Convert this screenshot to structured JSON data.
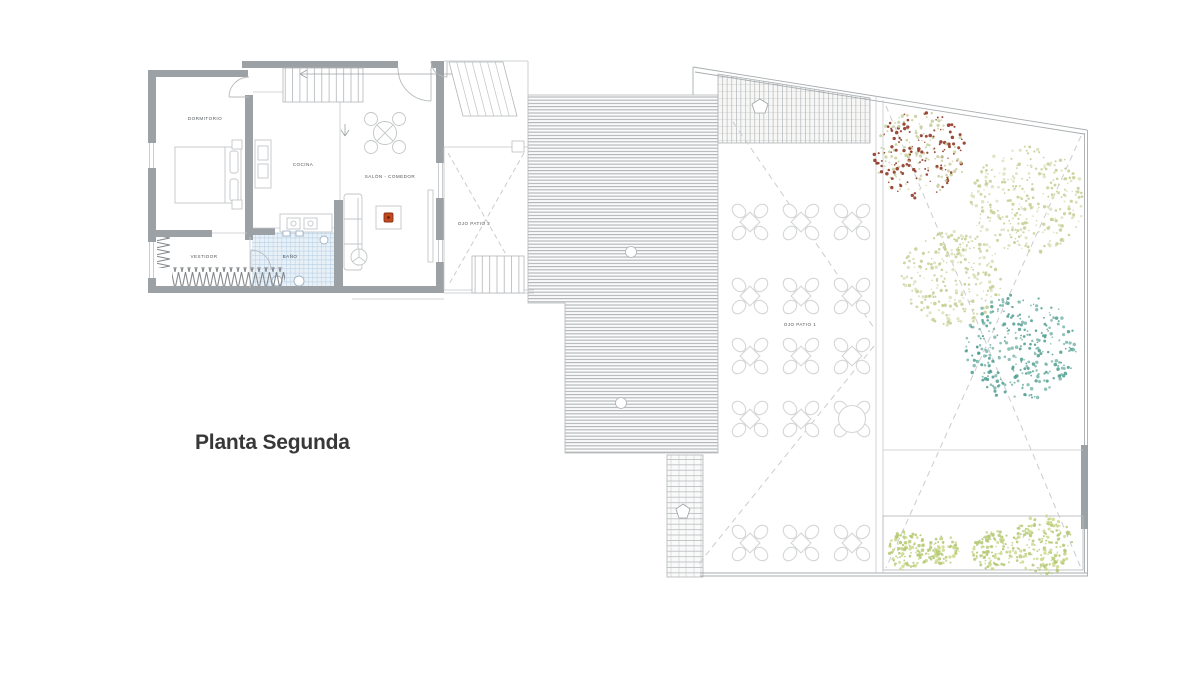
{
  "title": "Planta Segunda",
  "plan": {
    "rooms": {
      "dormitorio": "DORMITORIO",
      "cocina": "COCINA",
      "salon_comedor": "SALÓN - COMEDOR",
      "vestidor": "VESTIDOR",
      "bano": "BAÑO"
    },
    "patios": {
      "ojo_patio_2": "OJO PATIO 2",
      "ojo_patio_1": "OJO PATIO 1"
    }
  },
  "colors": {
    "wall_gray": "#9ba1a4",
    "line_gray": "#b2b6b9",
    "light_line": "#c6c9cb",
    "tile_blue": "#b7cfe3",
    "accent_red": "#bf4a21",
    "tree_red": "#8a2b16",
    "tree_olive": "#c6cd92",
    "tree_olive_light": "#dce1bb",
    "tree_teal": "#4e9c8e",
    "tree_teal_light": "#7db7ab",
    "shrub_green": "#b4c873",
    "shrub_green_light": "#cdd98f",
    "title_text": "#383838",
    "label_text": "#54585b"
  },
  "terrace": {
    "tables": {
      "cols_x": [
        750,
        801,
        852
      ],
      "rows_y": [
        222,
        296,
        356,
        419,
        543
      ],
      "large": {
        "row": 3,
        "col": 2
      }
    }
  },
  "trees": [
    {
      "name": "tree-red",
      "x": 920,
      "y": 155,
      "r": 46,
      "dots": 250,
      "mix": 0.5,
      "color": "#8a2b16",
      "color2": "#c8cf9d"
    },
    {
      "name": "tree-olive-top",
      "x": 1027,
      "y": 200,
      "r": 57,
      "dots": 300,
      "mix": 0.6,
      "color": "#c6cd92",
      "color2": "#dce1bb"
    },
    {
      "name": "tree-olive-mid",
      "x": 952,
      "y": 278,
      "r": 51,
      "dots": 260,
      "mix": 0.6,
      "color": "#c6cd92",
      "color2": "#dce1bb"
    },
    {
      "name": "tree-teal",
      "x": 1020,
      "y": 347,
      "r": 56,
      "dots": 300,
      "mix": 0.55,
      "color": "#4e9c8e",
      "color2": "#7db7ab"
    },
    {
      "name": "planter-shrub-1",
      "x": 908,
      "y": 551,
      "r": 21,
      "dots": 110,
      "mix": 0.6,
      "color": "#b4c873",
      "color2": "#cdd98f"
    },
    {
      "name": "planter-shrub-2",
      "x": 944,
      "y": 551,
      "r": 16,
      "dots": 80,
      "mix": 0.6,
      "color": "#b4c873",
      "color2": "#cdd98f"
    },
    {
      "name": "planter-shrub-3",
      "x": 993,
      "y": 550,
      "r": 21,
      "dots": 110,
      "mix": 0.6,
      "color": "#b4c873",
      "color2": "#cdd98f"
    },
    {
      "name": "planter-shrub-4",
      "x": 1043,
      "y": 545,
      "r": 31,
      "dots": 190,
      "mix": 0.6,
      "color": "#b4c873",
      "color2": "#cdd98f"
    }
  ]
}
